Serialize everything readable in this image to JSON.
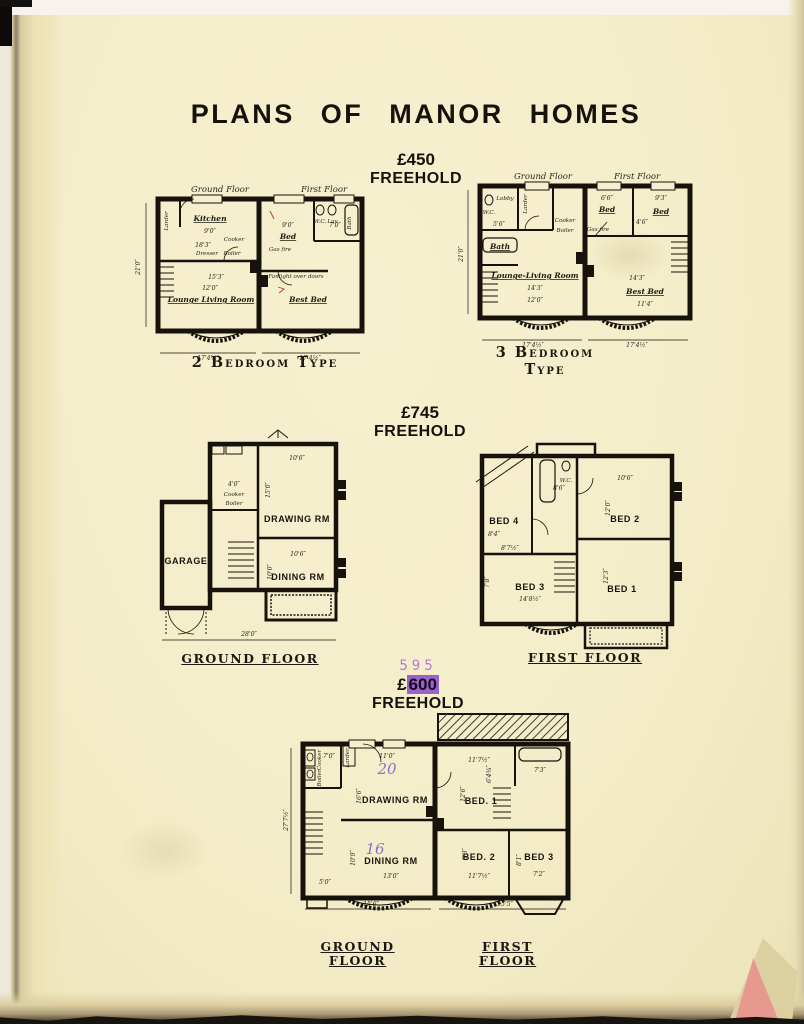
{
  "title": "PLANS OF MANOR HOMES",
  "sections": {
    "s450": {
      "price": "£450",
      "tenure": "FREEHOLD"
    },
    "s745": {
      "price": "£745",
      "tenure": "FREEHOLD"
    },
    "s600": {
      "stamp": "595",
      "currency": "£",
      "value": "600",
      "tenure": "FREEHOLD"
    }
  },
  "plan_2bed": {
    "header_ground": "Ground Floor",
    "header_first": "First Floor",
    "caption": "2 Bedroom Type",
    "rooms": {
      "larder": "Larder",
      "kitchen": "Kitchen",
      "cooker": "Cooker",
      "dresser": "Dresser",
      "boiler": "Boiler",
      "lounge": "Lounge Living Room",
      "bed": "Bed",
      "gas_fire": "Gas fire",
      "wc": "W.C.",
      "lav": "Lav.",
      "bath": "Bath",
      "fanlight": "Fanlight over doors",
      "best_bed": "Best Bed"
    },
    "dims": {
      "kitchen_width": "9'0″",
      "kitchen_depth": "18'3″",
      "lounge_span": "15'3″",
      "lounge_width": "12'0″",
      "height": "21'0″",
      "bed_width": "9'0″",
      "bath_width": "7'0″",
      "ground_width": "17'4¼″",
      "first_width": "17'4½″"
    }
  },
  "plan_3bed": {
    "header_ground": "Ground Floor",
    "header_first": "First Floor",
    "caption_line1": "3 Bedroom",
    "caption_line2": "Type",
    "rooms": {
      "wc": "W.C.",
      "lobby": "Lobby",
      "larder": "Larder",
      "cooker": "Cooker",
      "boiler": "Boiler",
      "bath": "Bath",
      "lounge": "Lounge-Living Room",
      "bed_back": "Bed",
      "bed_front": "Bed",
      "gas_fire": "Gas fire",
      "best_bed": "Best Bed"
    },
    "dims": {
      "hall_width": "5'6″",
      "bed_back_width": "6'6″",
      "bed_front_width": "9'3″",
      "bed_front_depth": "4'6″",
      "lounge_span": "14'3″",
      "lounge_width": "12'0″",
      "first_span": "14'3″",
      "best_bed_width": "11'4″",
      "height": "21'0″",
      "ground_width": "17'4½″",
      "first_width": "17'4½″"
    }
  },
  "plan_745_ground": {
    "caption": "Ground Floor",
    "rooms": {
      "garage": "GARAGE",
      "cooker": "Cooker",
      "boiler": "Boiler",
      "drawing": "DRAWING RM",
      "dining": "DINING RM"
    },
    "dims": {
      "pantry": "4'0″",
      "drawing_width": "10'6″",
      "drawing_depth": "15'0″",
      "dining_width": "10'6″",
      "dining_depth": "10'0″",
      "overall": "28'0″"
    }
  },
  "plan_745_first": {
    "caption": "First Floor",
    "rooms": {
      "wc": "W.C.",
      "bed1": "BED 1",
      "bed2": "BED 2",
      "bed3": "BED 3",
      "bed4": "BED 4"
    },
    "dims": {
      "bath_width": "8'6″",
      "bed2_width": "10'6″",
      "bed2_depth": "12'0″",
      "bed4_depth": "8'4″",
      "landing": "8'7½″",
      "bed3_side": "7'8″",
      "bed3_width": "14'8½″",
      "bed1_depth": "12'3″"
    }
  },
  "plan_600": {
    "caption_ground": "Ground Floor",
    "caption_first": "First Floor",
    "rooms": {
      "larder": "Larder",
      "cooker": "Cooker",
      "boiler": "Boiler",
      "drawing": "DRAWING RM",
      "dining": "DINING RM",
      "bed1": "BED. 1",
      "bed2": "BED. 2",
      "bed3": "BED 3"
    },
    "handwritten": {
      "drawing_area": "20",
      "dining_area": "16"
    },
    "dims": {
      "hall": "7'0″",
      "drawing_width": "11'0″",
      "drawing_depth": "16'6″",
      "dining_depth": "10'9″",
      "dining_width": "13'0″",
      "porch": "5'0″",
      "height": "27'7½″",
      "bed1_width": "11'7½″",
      "bed1_depth": "12'6″",
      "bath": "7'3″",
      "landing": "6'4¾″",
      "bed2_depth": "8'3″",
      "bed2_width": "11'7½″",
      "bed3_depth": "8'1″",
      "bed3_width": "7'2″",
      "ground_width": "15'6″",
      "first_width": "15'5″"
    }
  }
}
